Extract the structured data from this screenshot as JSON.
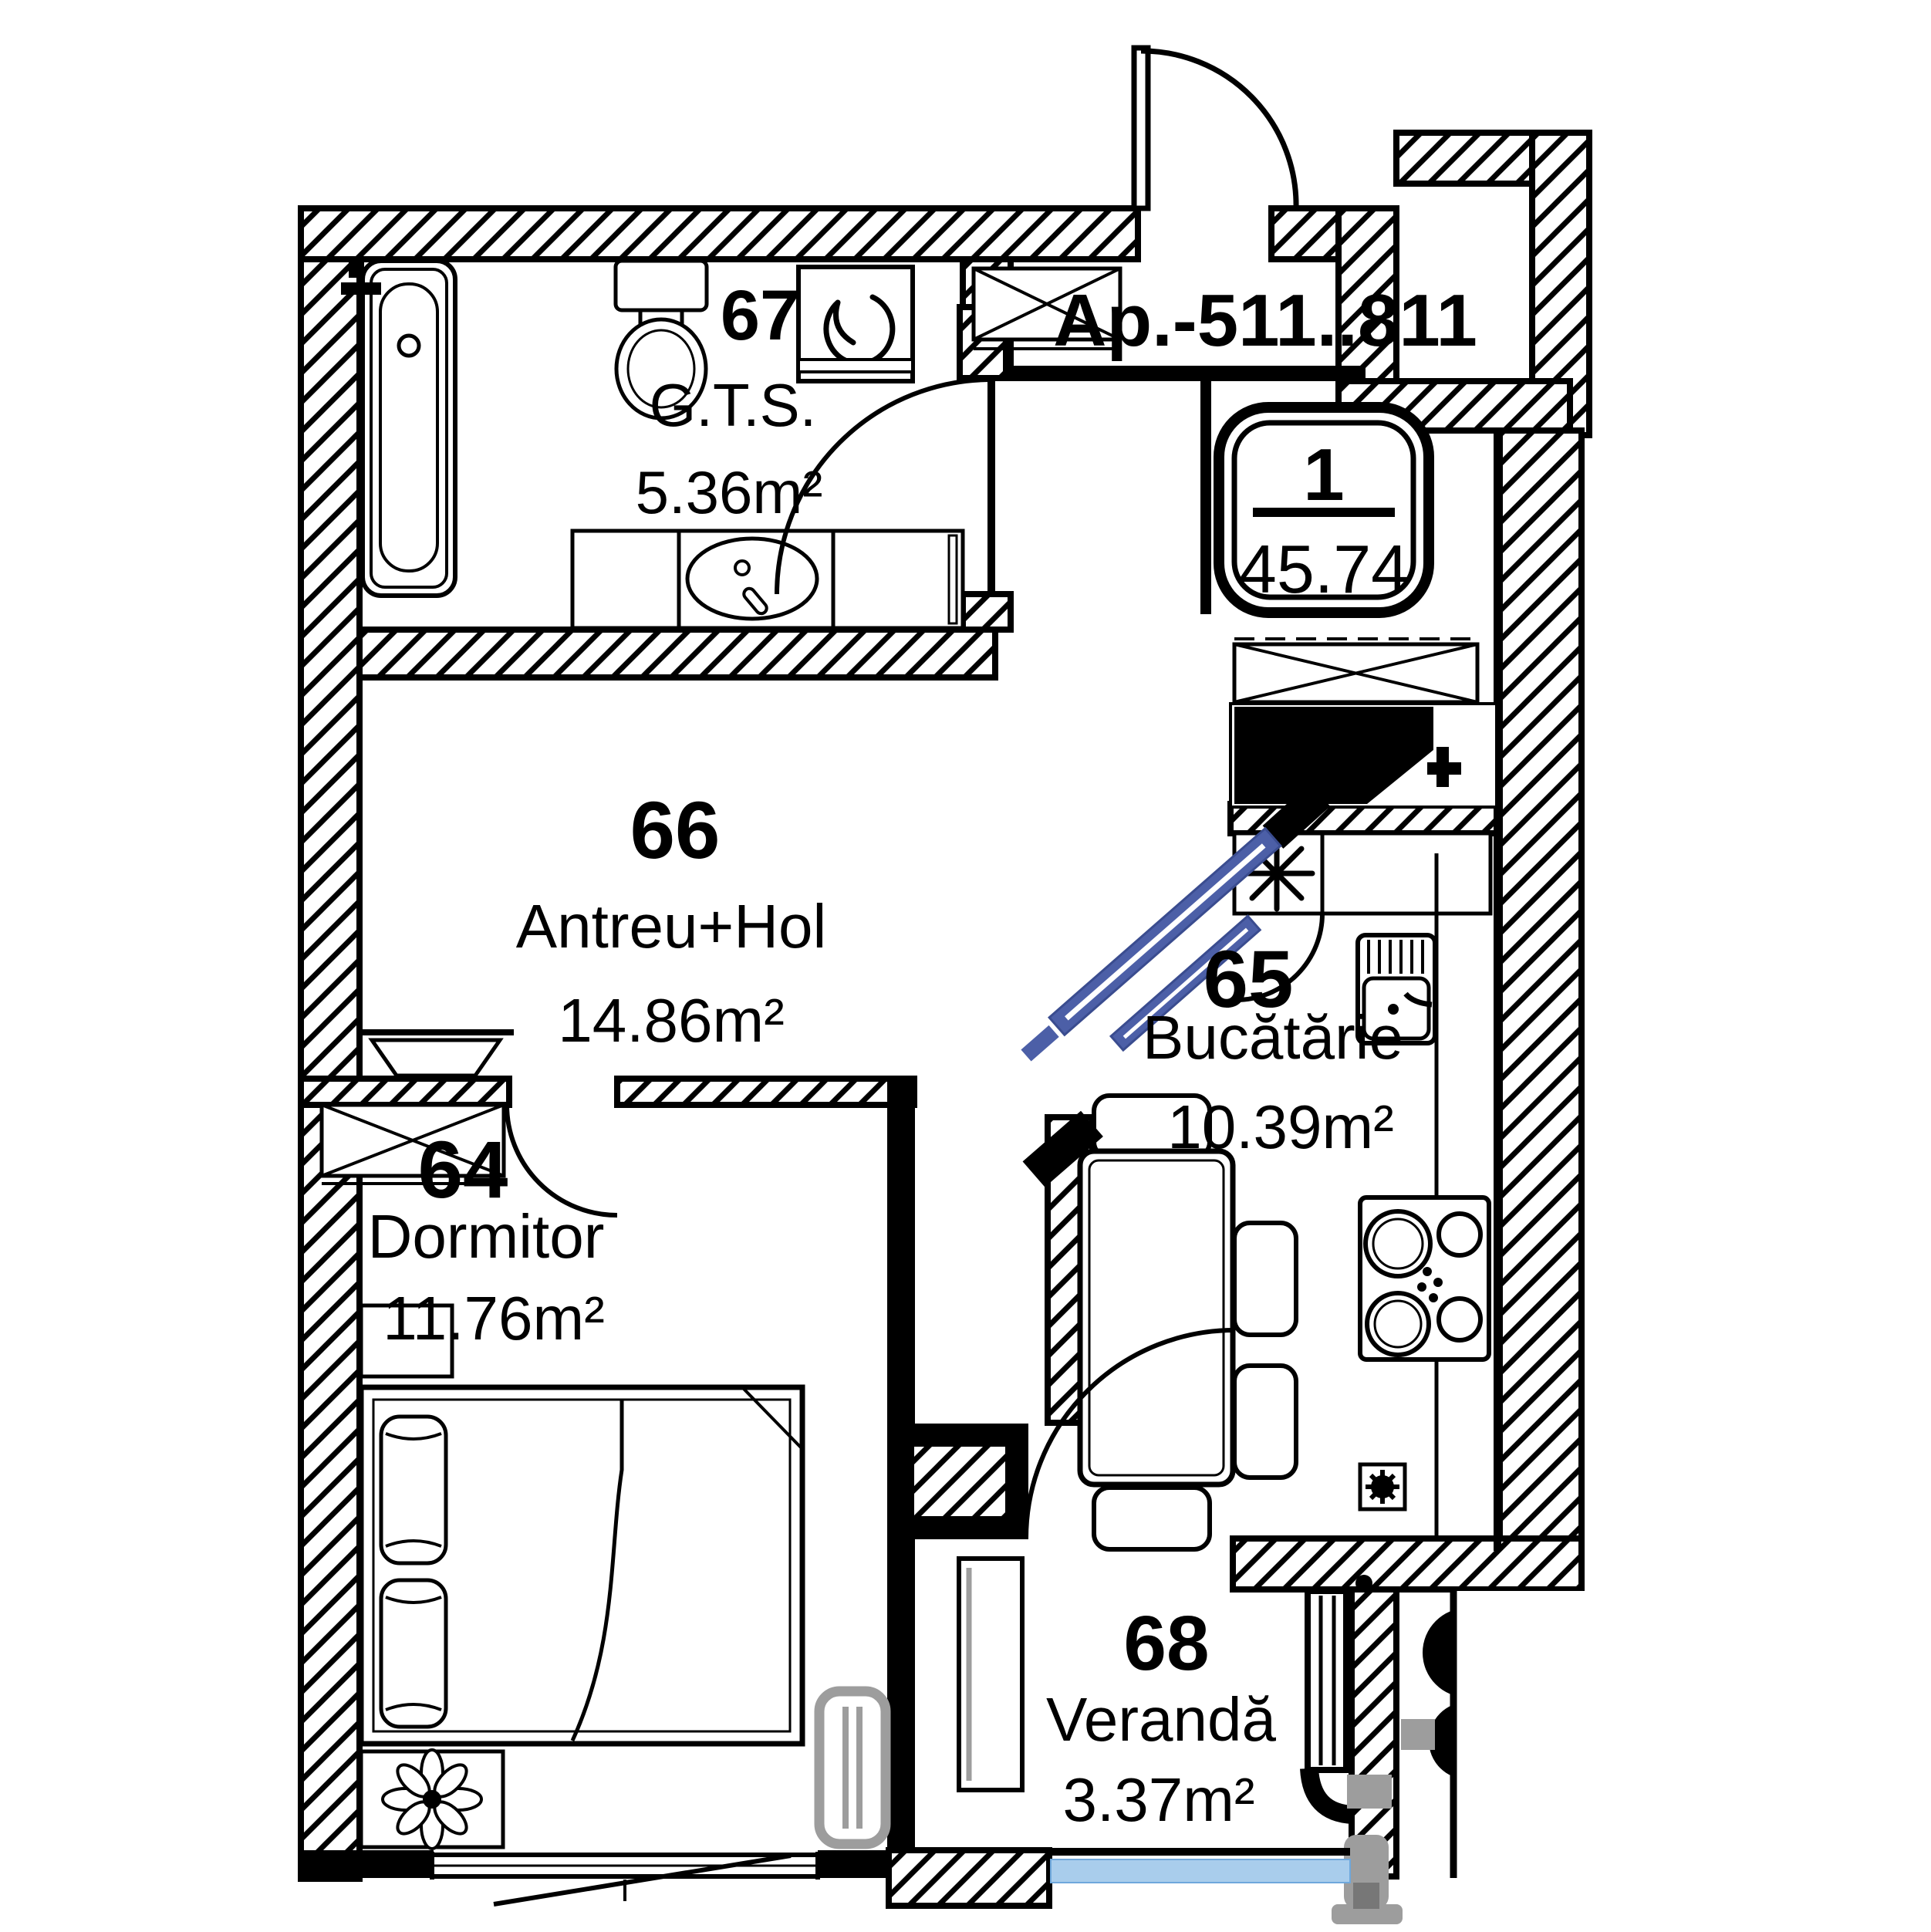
{
  "plan": {
    "apartment_label": "Ap.-511..811",
    "unit_badge": {
      "rooms": "1",
      "area": "45.74"
    },
    "rooms": [
      {
        "number": "67",
        "name": "G.T.S.",
        "area": "5.36m²"
      },
      {
        "number": "66",
        "name": "Antreu+Hol",
        "area": "14.86m²"
      },
      {
        "number": "65",
        "name": "Bucătărie",
        "area": "10.39m²"
      },
      {
        "number": "64",
        "name": "Dormitor",
        "area": "11.76m²"
      },
      {
        "number": "68",
        "name": "Verandă",
        "area": "3.37m²"
      }
    ],
    "colors": {
      "walls": "#000000",
      "sliding_door_blue": "#4C5FA7",
      "glazing_blue": "#A9CDEC",
      "fixture_gray": "#9D9D9D",
      "background": "#FFFFFF"
    },
    "icons": {
      "washing_machine": "swirl-icon",
      "boiler": "asterisk-icon",
      "plant": "flower-icon"
    }
  }
}
